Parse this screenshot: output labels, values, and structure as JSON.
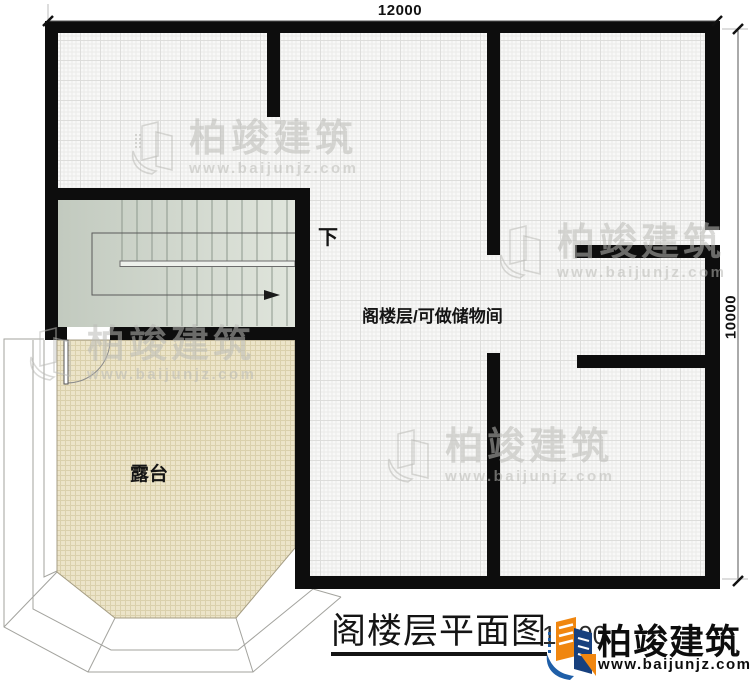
{
  "dimensions": {
    "top": "12000",
    "right": "10000"
  },
  "labels": {
    "down": "下",
    "room": "阁楼层/可做储物间",
    "terrace": "露台"
  },
  "title": {
    "text": "阁楼层平面图",
    "scale": "1:100"
  },
  "brand": {
    "name": "柏竣建筑",
    "url": "www.baijunjz.com"
  },
  "watermark": {
    "name": "柏竣建筑",
    "url": "www.baijunjz.com"
  },
  "colors": {
    "wall": "#0d0d0d",
    "room_fill": "#f8f8f7",
    "terrace_fill": "#ece4c9",
    "stair_fill": "#d3dad1",
    "logo_orange": "#f0860f",
    "logo_blue": "#1f5fa8"
  }
}
